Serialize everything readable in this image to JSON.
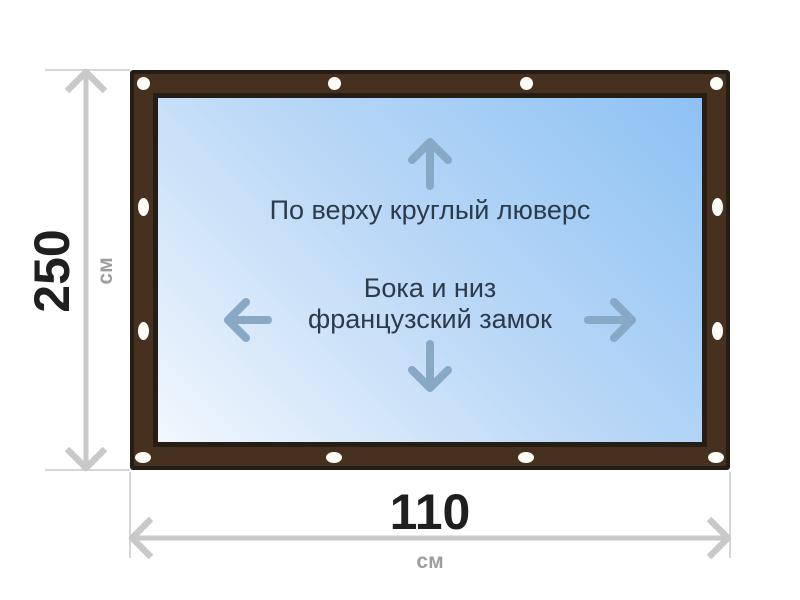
{
  "annotations": {
    "top_edge": "По верху круглый люверс",
    "sides_bottom_line1": "Бока и низ",
    "sides_bottom_line2": "французский замок"
  },
  "dimensions": {
    "height": {
      "value": "250",
      "unit": "см"
    },
    "width": {
      "value": "110",
      "unit": "см"
    }
  },
  "icons": {
    "up": "arrow-up-icon",
    "down": "arrow-down-icon",
    "left": "arrow-left-icon",
    "right": "arrow-right-icon"
  },
  "grommet_count": 12,
  "colors": {
    "frame_fill": "#46301f",
    "frame_outline": "#261e14",
    "window_gradient_start": "#f2f7fd",
    "window_gradient_end": "#8dc1f3",
    "grommet": "#fdfcf6",
    "dimension_line": "#c9c9c9",
    "dimension_value_text": "#1f1f1f",
    "dimension_unit_text": "#9d9d9d",
    "annotation_text": "#2c3a4a",
    "direction_arrow": "#87a9c6"
  }
}
